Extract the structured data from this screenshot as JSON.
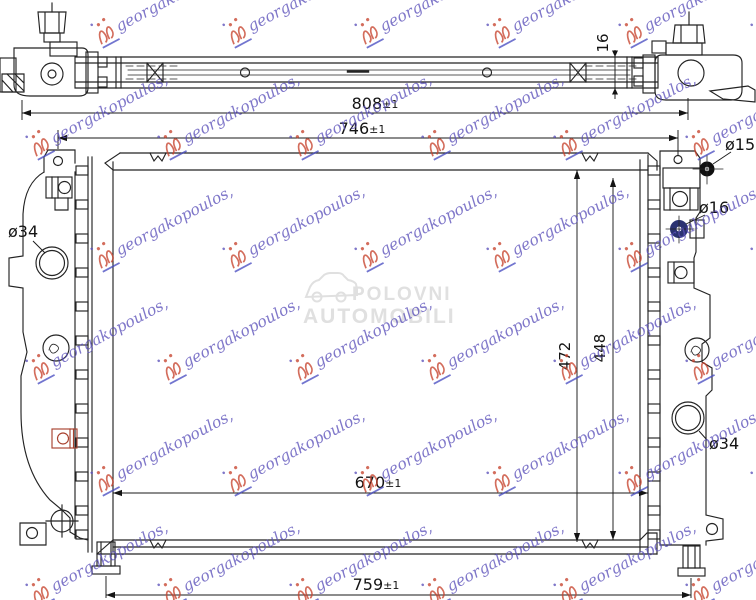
{
  "drawing": {
    "watermark": {
      "text": "georgakopoulos,",
      "text_color": "#5b50ba",
      "logo_color": "#c7432e"
    },
    "center_watermark": {
      "line1": "POLOVNI",
      "line2": "AUTOMOBILI",
      "color": "#e0e0e0"
    },
    "dimensions": {
      "overall_width": {
        "value": "808",
        "tol": "±1"
      },
      "upper_mount_width": {
        "value": "746",
        "tol": "±1"
      },
      "core_width": {
        "value": "670",
        "tol": "±1"
      },
      "lower_mount_width": {
        "value": "759",
        "tol": "±1"
      },
      "thickness": {
        "value": "16"
      },
      "height_left": {
        "value": "472"
      },
      "height_right": {
        "value": "448"
      },
      "inlet_diameter": {
        "value": "ø34"
      },
      "outlet_diameter": {
        "value": "ø34"
      },
      "pipe_top_diameter": {
        "value": "ø15"
      },
      "pipe_mid_diameter": {
        "value": "ø16"
      }
    }
  }
}
